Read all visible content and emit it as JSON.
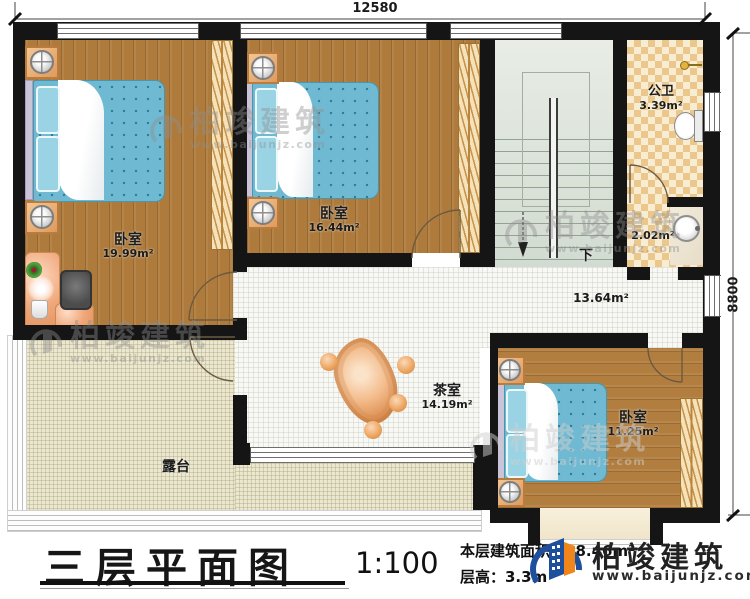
{
  "plan": {
    "dim_top": "12580",
    "dim_right": "8800",
    "stairs_down": "下",
    "rooms": {
      "bedroom1": {
        "name": "卧室",
        "area": "19.99m²"
      },
      "bedroom2": {
        "name": "卧室",
        "area": "16.44m²"
      },
      "bedroom3": {
        "name": "卧室",
        "area": "11.25m²"
      },
      "bathroom": {
        "name": "公卫",
        "area": "3.39m²"
      },
      "washroom": {
        "area": "2.02m²"
      },
      "hallway": {
        "area": "13.64m²"
      },
      "tearoom": {
        "name": "茶室",
        "area": "14.19m²"
      },
      "terrace": {
        "name": "露台"
      }
    }
  },
  "titleblock": {
    "title": "三层平面图",
    "scale": "1:100",
    "area_label": "本层建筑面积：98.46m²",
    "floor_height": "层高：3.3m"
  },
  "brand": {
    "name": "柏竣建筑",
    "url": "www.baijunjz.com",
    "blue": "#1d4f9c",
    "orange": "#f08519"
  },
  "watermark": {
    "name": "柏竣建筑",
    "url": "www.baijunjz.com"
  },
  "colors": {
    "wall": "#151515",
    "wood": "#ae7b3d",
    "mattress": "#6fbad2",
    "bath_tile": "#ebc78c",
    "stairs": "#d9e0d7",
    "terrace": "#ebe7d0"
  }
}
